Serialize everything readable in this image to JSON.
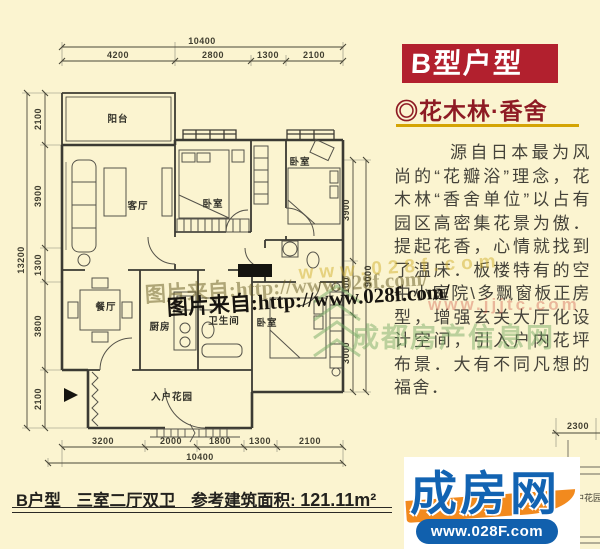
{
  "page": {
    "bg": "#fbf4d0"
  },
  "sidebar": {
    "title": "B型户型",
    "title_bg": "#b2202e",
    "subtitle": "◎花木林·香舍",
    "subtitle_color": "#8e1b24",
    "underline_color": "#d4a404",
    "paragraph": "源自日本最为风尚的“花瓣浴”理念，花木林“香舍单位”以占有园区高密集花景为傲．提起花香，心情就找到了温床．板楼特有的空中小庭院\\多飘窗板正房型，增强玄关大厅化设计空间，引入户内花坪布景．大有不同凡想的福舍．"
  },
  "floorplan": {
    "labels": [
      {
        "text": "阳台"
      },
      {
        "text": "客厅"
      },
      {
        "text": "卧室"
      },
      {
        "text": "卧室"
      },
      {
        "text": "餐厅"
      },
      {
        "text": "厨房"
      },
      {
        "text": "卫生间"
      },
      {
        "text": "卧室"
      },
      {
        "text": "入户花园"
      }
    ],
    "dims": {
      "top_total": "10400",
      "top_segments": [
        "4200",
        "2800",
        "1300",
        "2100"
      ],
      "left_total": "13200",
      "left_segments": [
        "2100",
        "3900",
        "1300",
        "3800",
        "2100"
      ],
      "right_total": "9000",
      "right_segments": [
        "3900",
        "2100",
        "3000"
      ],
      "bottom_total": "10400",
      "bottom_segments": [
        "3200",
        "2000",
        "1800",
        "1300",
        "2100"
      ],
      "adjacent_dim": "2300"
    },
    "adjacent_label": "中花园"
  },
  "watermarks": {
    "credit": "图片来自:http://www.028f.com/",
    "yellow_url": "www.028f.com",
    "red_url": "www.jjjtc.com",
    "green_site_name": "成都房产信息网"
  },
  "caption": {
    "unit": "B户型",
    "layout": "三室二厅双卫",
    "area_label": "参考建筑面积:",
    "area_value": "121.11m²"
  },
  "logo": {
    "name": "成房网",
    "url": "www.028F.com",
    "blue": "#1263b2",
    "orange": "#f28a1e"
  }
}
